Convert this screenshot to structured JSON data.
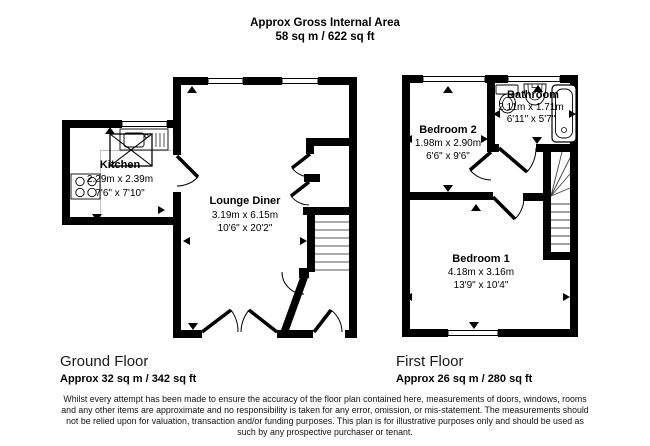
{
  "header": {
    "line1": "Approx Gross Internal Area",
    "line2": "58 sq m / 622 sq ft"
  },
  "ground_floor": {
    "label": "Ground Floor",
    "area": "Approx 32 sq m / 342 sq ft",
    "kitchen": {
      "name": "Kitchen",
      "metric": "2.29m x 2.39m",
      "imperial": "7'6\" x 7'10\""
    },
    "lounge_diner": {
      "name": "Lounge Diner",
      "metric": "3.19m x 6.15m",
      "imperial": "10'6\" x 20'2\""
    }
  },
  "first_floor": {
    "label": "First Floor",
    "area": "Approx 26 sq m / 280 sq ft",
    "bedroom2": {
      "name": "Bedroom 2",
      "metric": "1.98m x 2.90m",
      "imperial": "6'6\" x 9'6\""
    },
    "bathroom": {
      "name": "Bathroom",
      "metric": "2.11m x 1.71m",
      "imperial": "6'11\" x 5'7\""
    },
    "bedroom1": {
      "name": "Bedroom 1",
      "metric": "4.18m x 3.16m",
      "imperial": "13'9\" x 10'4\""
    }
  },
  "disclaimer": "Whilst every attempt has been made to ensure the accuracy of the floor plan contained here, measurements of doors, windows, rooms and any other items are approximate and no responsibility is taken for any error, omission, or mis-statement. The measurements should not be relied upon for valuation, transaction and/or funding purposes. This plan is for illustrative purposes only and should be used as such by any prospective purchaser or tenant.",
  "colors": {
    "wall": "#000000",
    "background": "#ffffff"
  }
}
